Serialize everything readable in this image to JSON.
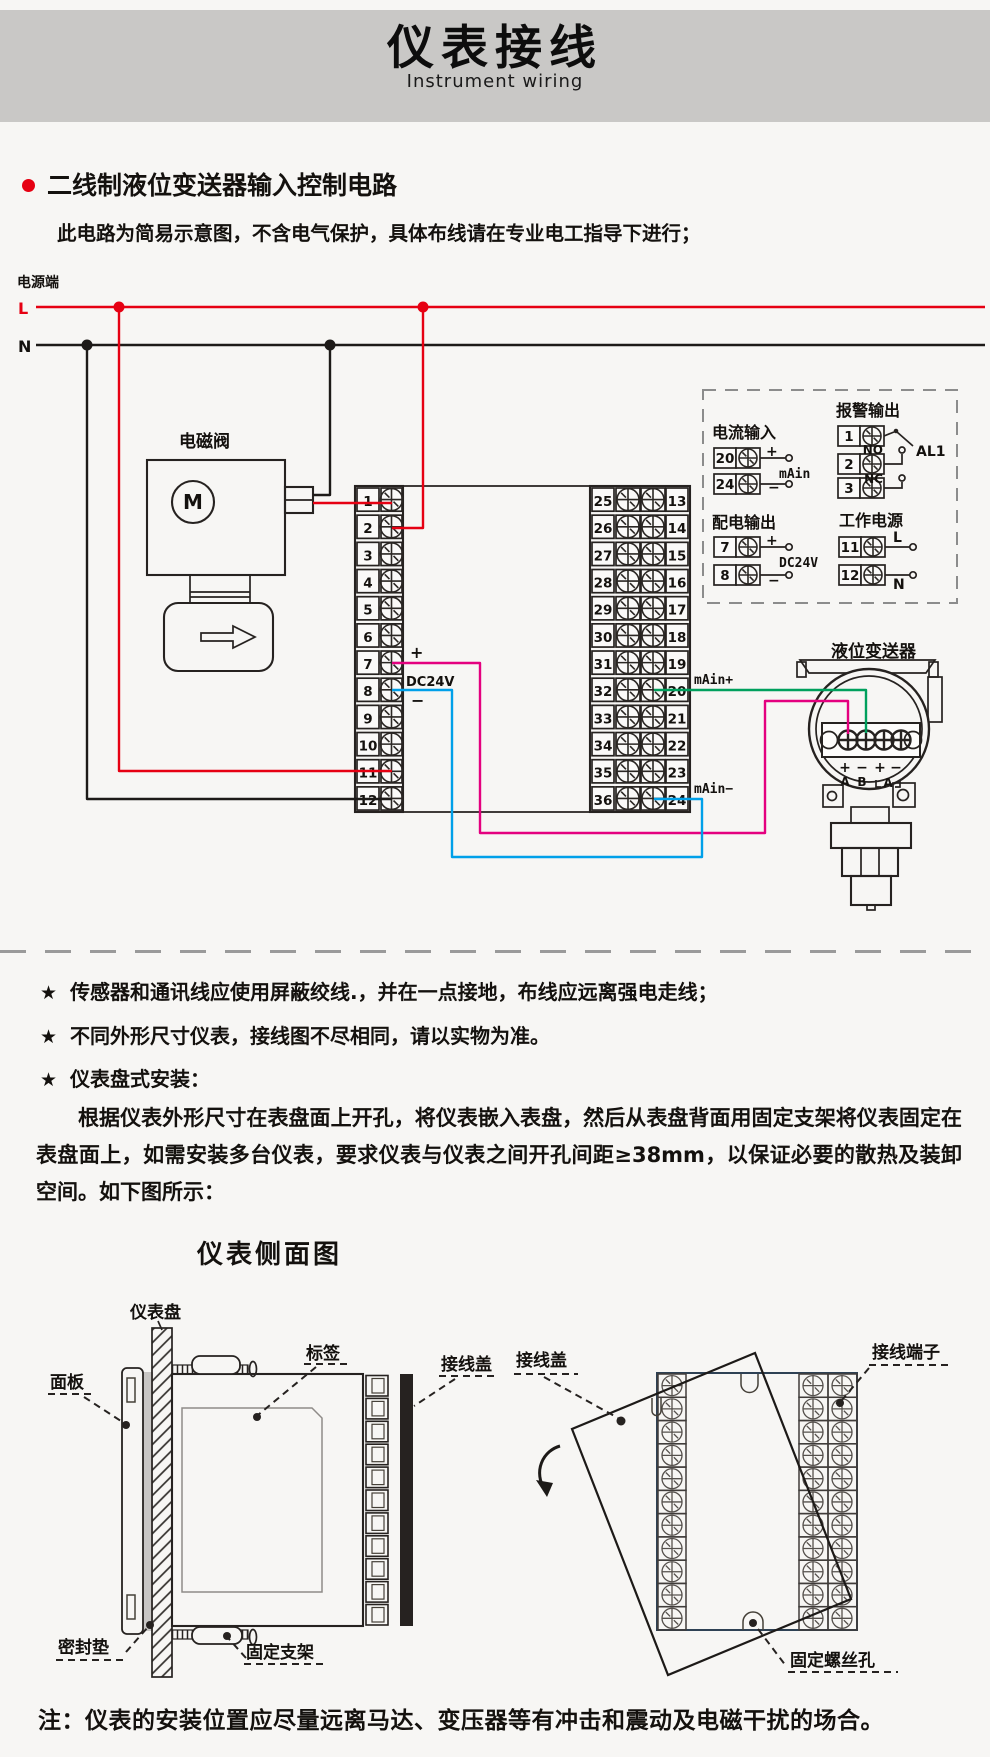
{
  "header": {
    "title": "仪表接线",
    "subtitle": "Instrument wiring"
  },
  "section": {
    "title": "二线制液位变送器输入控制电路",
    "note": "此电路为简易示意图，不含电气保护，具体布线请在专业电工指导下进行；"
  },
  "colors": {
    "banner": "#c9c8c6",
    "accent_red": "#e60012",
    "wire_magenta": "#e4007f",
    "wire_blue": "#00a0e9",
    "wire_green": "#00a05d",
    "rear_outline": "#2e4154"
  },
  "diagram": {
    "power_label": "电源端",
    "line_l": "L",
    "line_n": "N",
    "solenoid_label": "电磁阀",
    "motor_label": "M",
    "plus": "+",
    "minus": "−",
    "dc24v": "DC24V",
    "main_plus": "mAin+",
    "main_minus": "mAin−",
    "left_terminals": [
      "1",
      "2",
      "3",
      "4",
      "5",
      "6",
      "7",
      "8",
      "9",
      "10",
      "11",
      "12"
    ],
    "right_terminals_left": [
      "25",
      "26",
      "27",
      "28",
      "29",
      "30",
      "31",
      "32",
      "33",
      "34",
      "35",
      "36"
    ],
    "right_terminals_right": [
      "13",
      "14",
      "15",
      "16",
      "17",
      "18",
      "19",
      "20",
      "21",
      "22",
      "23",
      "24"
    ],
    "legend": {
      "current_input": {
        "title": "电流输入",
        "t1": "20",
        "t2": "24",
        "plus": "+",
        "minus": "−",
        "label": "mAin"
      },
      "alarm_output": {
        "title": "报警输出",
        "t1": "1",
        "t2": "2",
        "t3": "3",
        "no": "NO",
        "nc": "NC",
        "name": "AL1"
      },
      "power_output": {
        "title": "配电输出",
        "t1": "7",
        "t2": "8",
        "plus": "+",
        "minus": "−",
        "label": "DC24V"
      },
      "work_power": {
        "title": "工作电源",
        "t1": "11",
        "t2": "12",
        "l": "L",
        "n": "N"
      }
    },
    "transmitter": {
      "label": "液位变送器",
      "pin_signs": [
        "+",
        "−",
        "+",
        "−"
      ],
      "pin_names": [
        "A",
        "B",
        "A"
      ]
    }
  },
  "notes": {
    "star": "★",
    "items": [
      "传感器和通讯线应使用屏蔽绞线.，并在一点接地，布线应远离强电走线；",
      "不同外形尺寸仪表，接线图不尽相同，请以实物为准。",
      "仪表盘式安装："
    ]
  },
  "install": {
    "paragraph": "根据仪表外形尺寸在表盘面上开孔，将仪表嵌入表盘，然后从表盘背面用固定支架将仪表固定在表盘面上，如需安装多台仪表，要求仪表与仪表之间开孔间距≥38mm，以保证必要的散热及装卸空间。如下图所示：",
    "side_view_title": "仪表侧面图",
    "labels": {
      "panel_board": "仪表盘",
      "front_panel": "面板",
      "tag": "标签",
      "wire_cover": "接线盖",
      "gasket": "密封垫",
      "bracket": "固定支架",
      "terminals": "接线端子",
      "screw_hole": "固定螺丝孔"
    }
  },
  "footer_note": "注：仪表的安装位置应尽量远离马达、变压器等有冲击和震动及电磁干扰的场合。"
}
